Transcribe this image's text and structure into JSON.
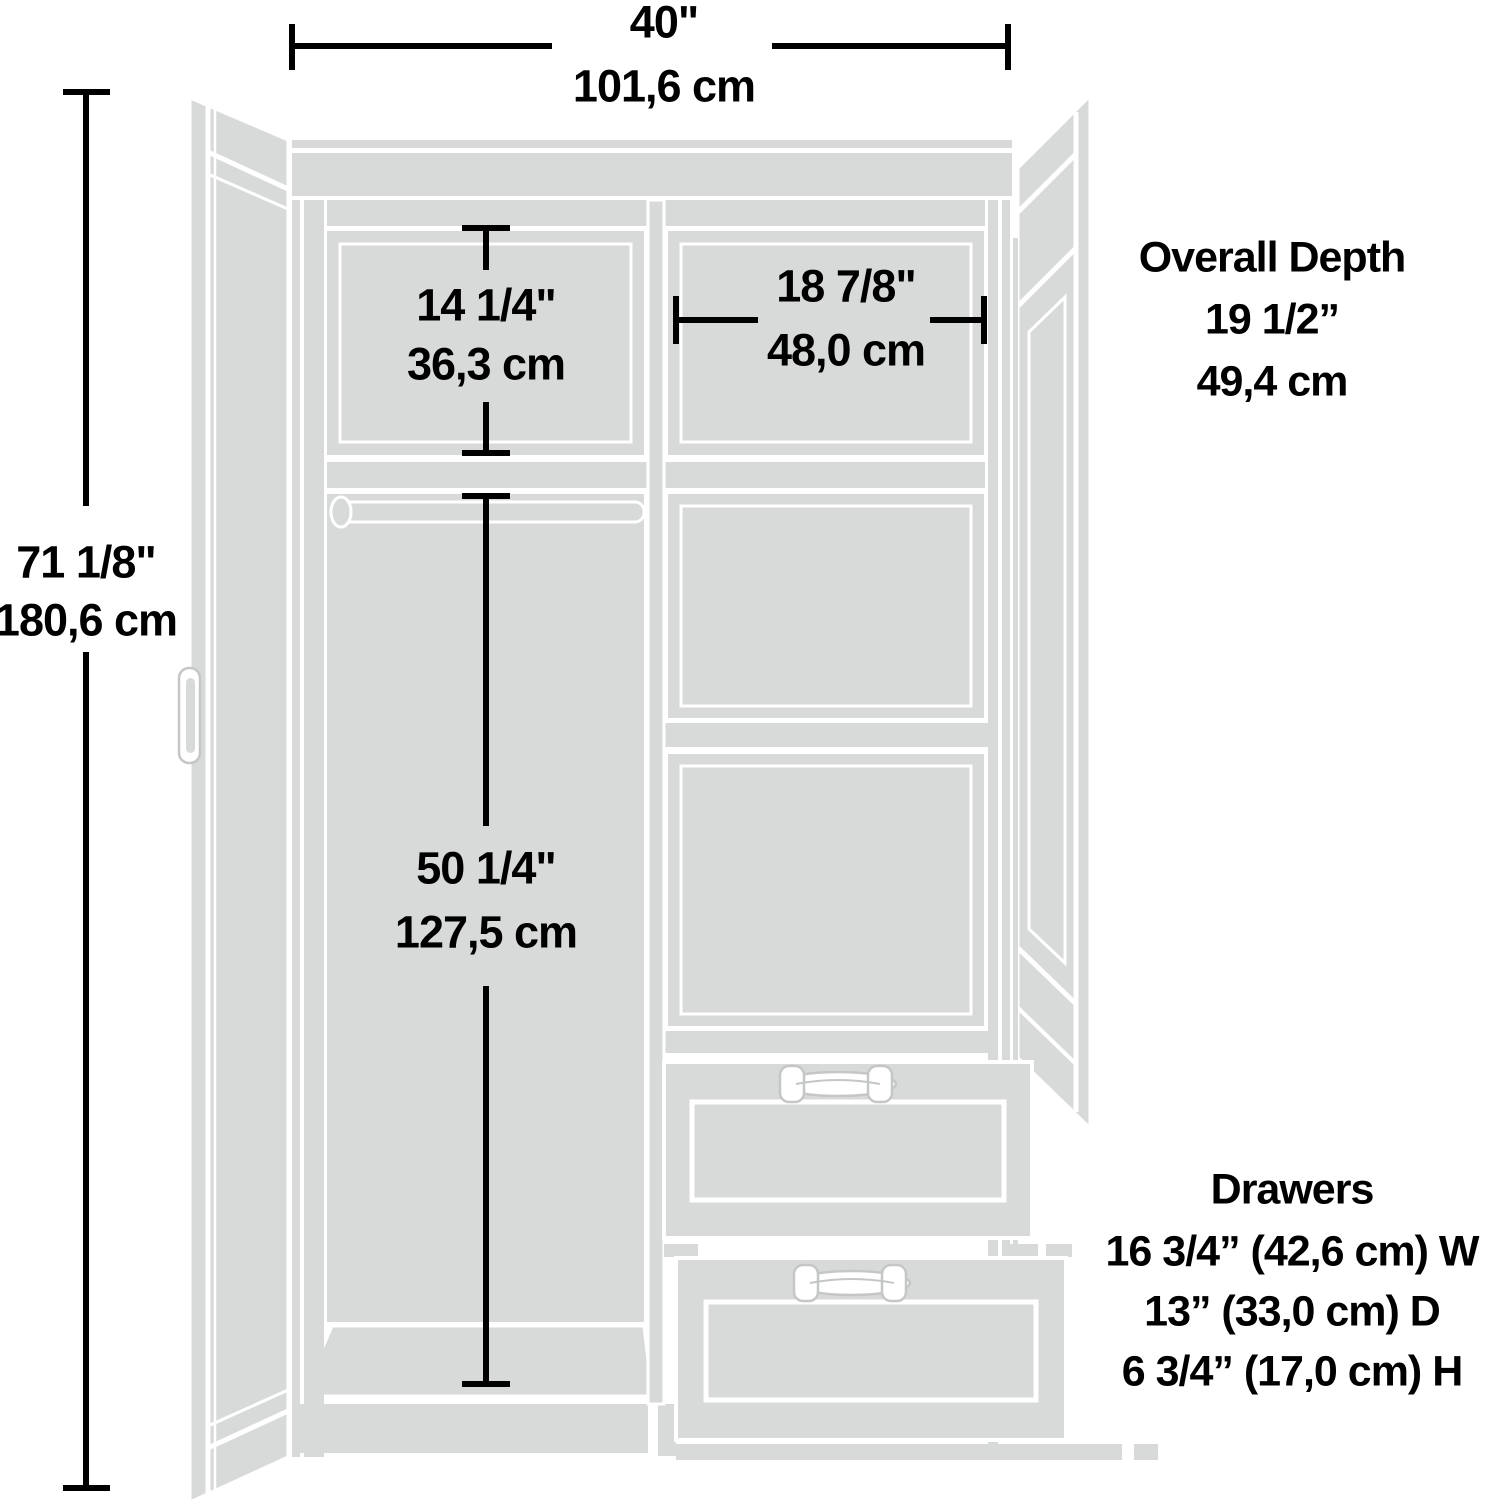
{
  "colors": {
    "cabinet_fill": "#d8dada",
    "gap_white": "#ffffff",
    "dimension_line": "#000000",
    "handle_outline": "#c5c7c7"
  },
  "dimensions": {
    "overall_width": {
      "inches": "40\"",
      "metric": "101,6 cm"
    },
    "overall_height": {
      "inches": "71 1/8\"",
      "metric": "180,6 cm"
    },
    "upper_left_compartment": {
      "inches": "14 1/4\"",
      "metric": "36,3 cm"
    },
    "upper_right_compartment": {
      "inches": "18 7/8\"",
      "metric": "48,0 cm"
    },
    "hanging_compartment": {
      "inches": "50 1/4\"",
      "metric": "127,5 cm"
    },
    "overall_depth": {
      "label": "Overall Depth",
      "inches": "19 1/2”",
      "metric": "49,4 cm"
    },
    "drawers": {
      "label": "Drawers",
      "width": "16 3/4” (42,6 cm) W",
      "depth": "13” (33,0 cm) D",
      "height": "6 3/4” (17,0 cm) H"
    }
  }
}
